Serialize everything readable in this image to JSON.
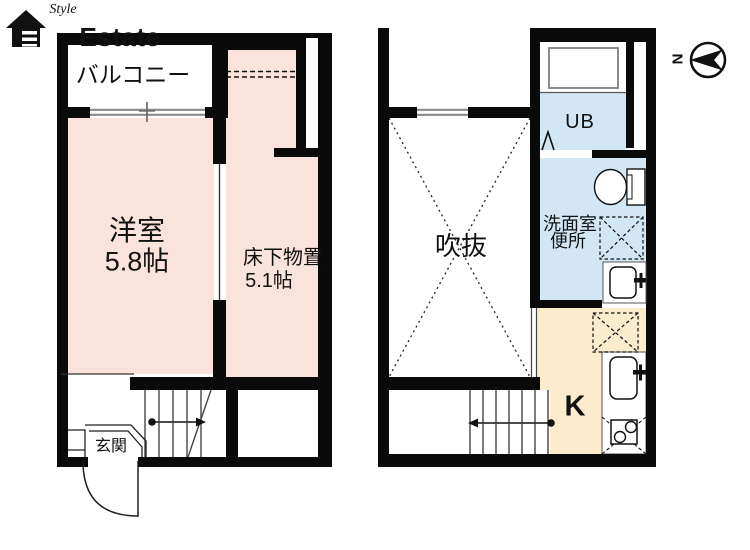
{
  "brand": {
    "script": "Style",
    "name": "Estate"
  },
  "compass": {
    "north": "N"
  },
  "left_floor": {
    "balcony": "バルコニー",
    "room": "洋室",
    "room_size": "5.8帖",
    "storage": "床下物置",
    "storage_size": "5.1帖",
    "entrance": "玄関"
  },
  "right_floor": {
    "atrium": "吹抜",
    "unit_bath": "UB",
    "washroom": "洗面室",
    "toilet": "便所",
    "kitchen": "K"
  },
  "colors": {
    "room_pink": "#fae3dc",
    "wet_blue": "#d2e7f3",
    "kitchen_beige": "#faeccd",
    "wall_black": "#0a0a0a",
    "window_gray": "#8a8a8a"
  }
}
